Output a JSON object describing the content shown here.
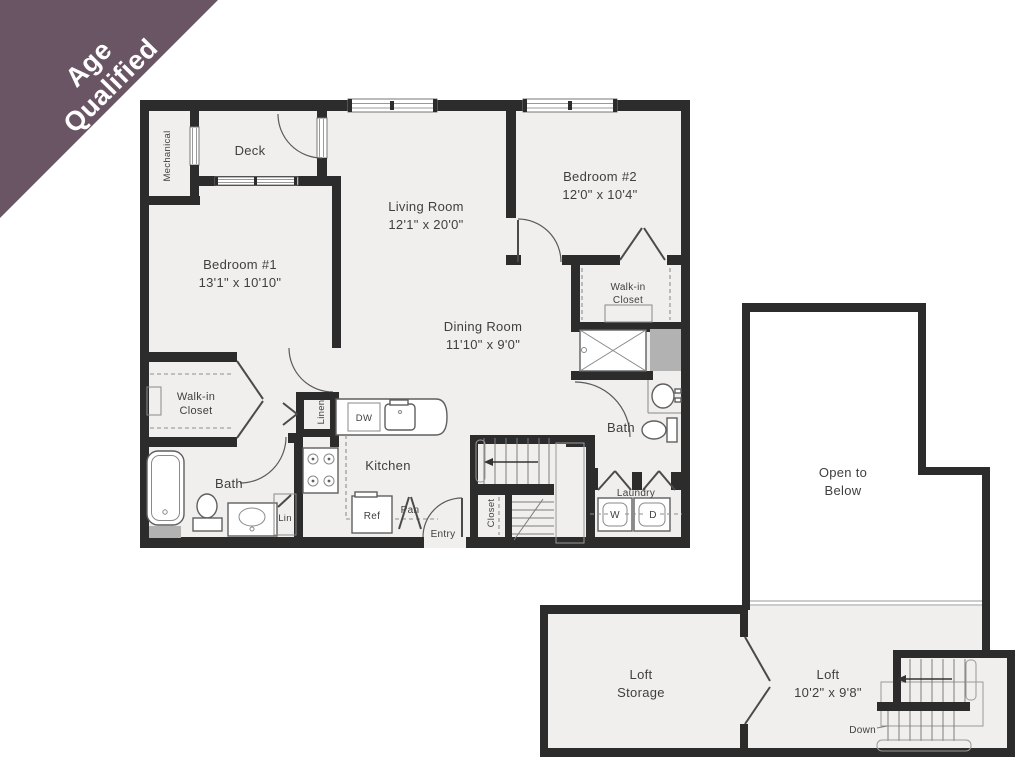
{
  "banner": {
    "line1": "Age",
    "line2": "Qualified",
    "color": "#6a5565"
  },
  "palette": {
    "wall": "#2c2c2c",
    "floor": "#f0efee",
    "chase": "#b3b2b2",
    "text": "#3f3f3f"
  },
  "main_floor": {
    "mechanical": "Mechanical",
    "deck": "Deck",
    "living_room": {
      "name": "Living Room",
      "dims": "12'1\" x 20'0\""
    },
    "bedroom_1": {
      "name": "Bedroom #1",
      "dims": "13'1\" x 10'10\""
    },
    "bedroom_2": {
      "name": "Bedroom #2",
      "dims": "12'0\" x 10'4\""
    },
    "dining_room": {
      "name": "Dining Room",
      "dims": "11'10\" x 9'0\""
    },
    "kitchen": "Kitchen",
    "walk_in_closet_1": {
      "line1": "Walk-in",
      "line2": "Closet"
    },
    "walk_in_closet_2": {
      "line1": "Walk-in",
      "line2": "Closet"
    },
    "bath_1": "Bath",
    "bath_2": "Bath",
    "laundry": {
      "label": "Laundry",
      "washer": "W",
      "dryer": "D"
    },
    "entry": "Entry",
    "stair_closet": "Closet",
    "linen_tall": "Linen",
    "linen_small": "Lin",
    "dishwasher": "DW",
    "refrigerator": "Ref",
    "pantry": "Pan"
  },
  "loft_floor": {
    "open_to_below": {
      "line1": "Open to",
      "line2": "Below"
    },
    "loft": {
      "name": "Loft",
      "dims": "10'2\" x 9'8\""
    },
    "loft_storage": {
      "line1": "Loft",
      "line2": "Storage"
    },
    "down": "Down"
  }
}
